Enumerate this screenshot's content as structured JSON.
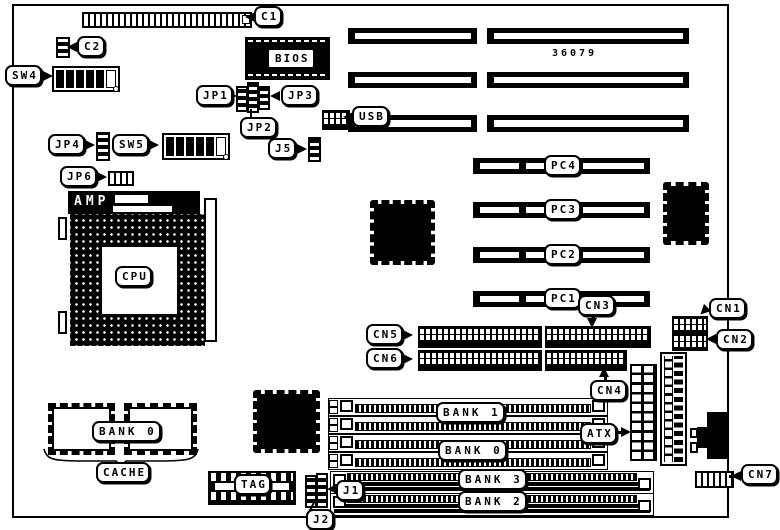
{
  "labels": {
    "c1": "C1",
    "c2": "C2",
    "sw4": "SW4",
    "bios": "BIOS",
    "jp1": "JP1",
    "jp3": "JP3",
    "jp2": "JP2",
    "usb": "USB",
    "jp4": "JP4",
    "sw5": "SW5",
    "j5": "J5",
    "jp6": "JP6",
    "amp": "AMP",
    "cpu": "CPU",
    "part_number": "36079",
    "pc4": "PC4",
    "pc3": "PC3",
    "pc2": "PC2",
    "pc1": "PC1",
    "cn1": "CN1",
    "cn2": "CN2",
    "cn3": "CN3",
    "cn4": "CN4",
    "cn5": "CN5",
    "cn6": "CN6",
    "cn7": "CN7",
    "atx": "ATX",
    "bank1": "BANK 1",
    "bank0_memory": "BANK 0",
    "bank3": "BANK 3",
    "bank2": "BANK 2",
    "j1": "J1",
    "j2": "J2",
    "bank0_cache": "BANK 0",
    "cache": "CACHE",
    "tag": "TAG"
  },
  "colors": {
    "ink": "#000000",
    "paper": "#ffffff"
  }
}
